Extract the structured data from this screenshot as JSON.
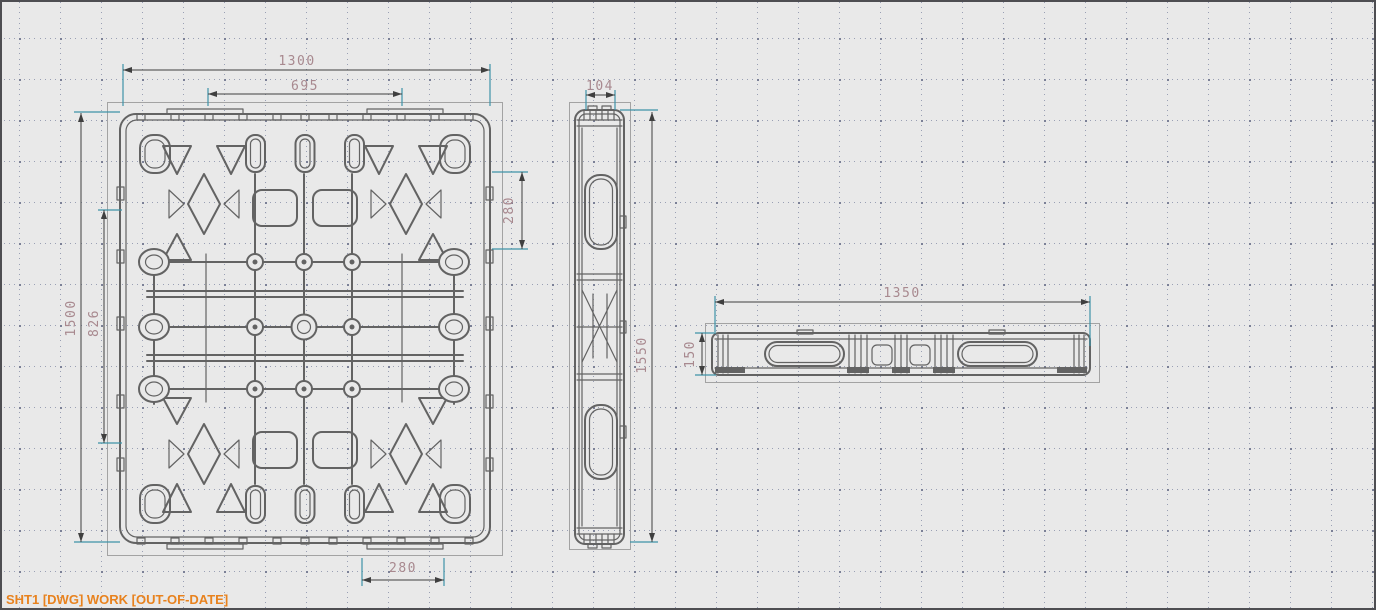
{
  "window": {
    "status_bar": {
      "text": "SHT1 [DWG] WORK [OUT-OF-DATE]"
    }
  },
  "colors": {
    "background": "#e9e9e9",
    "border": "#4e4e52",
    "geometry_line": "#636363",
    "view_frame": "#a3a3a3",
    "dimension_line": "#3f3f3f",
    "extension_line": "#3f93a8",
    "dimension_text": "#a8898f",
    "status_text": "#e8821e",
    "grid_dot": "#9aa0b4"
  },
  "drawing": {
    "views": {
      "top": {
        "name": "pallet top view"
      },
      "side": {
        "name": "pallet side view"
      },
      "front": {
        "name": "pallet front view"
      }
    },
    "dimensions": {
      "top_overall_width": "1300",
      "top_tab_span": "695",
      "right_pocket_height": "280",
      "top_overall_depth": "1500",
      "left_inner_span": "826",
      "bottom_tab_width": "280",
      "side_thickness": "104",
      "side_overall_length": "1550",
      "front_overall_width": "1350",
      "front_overall_height": "150"
    }
  }
}
